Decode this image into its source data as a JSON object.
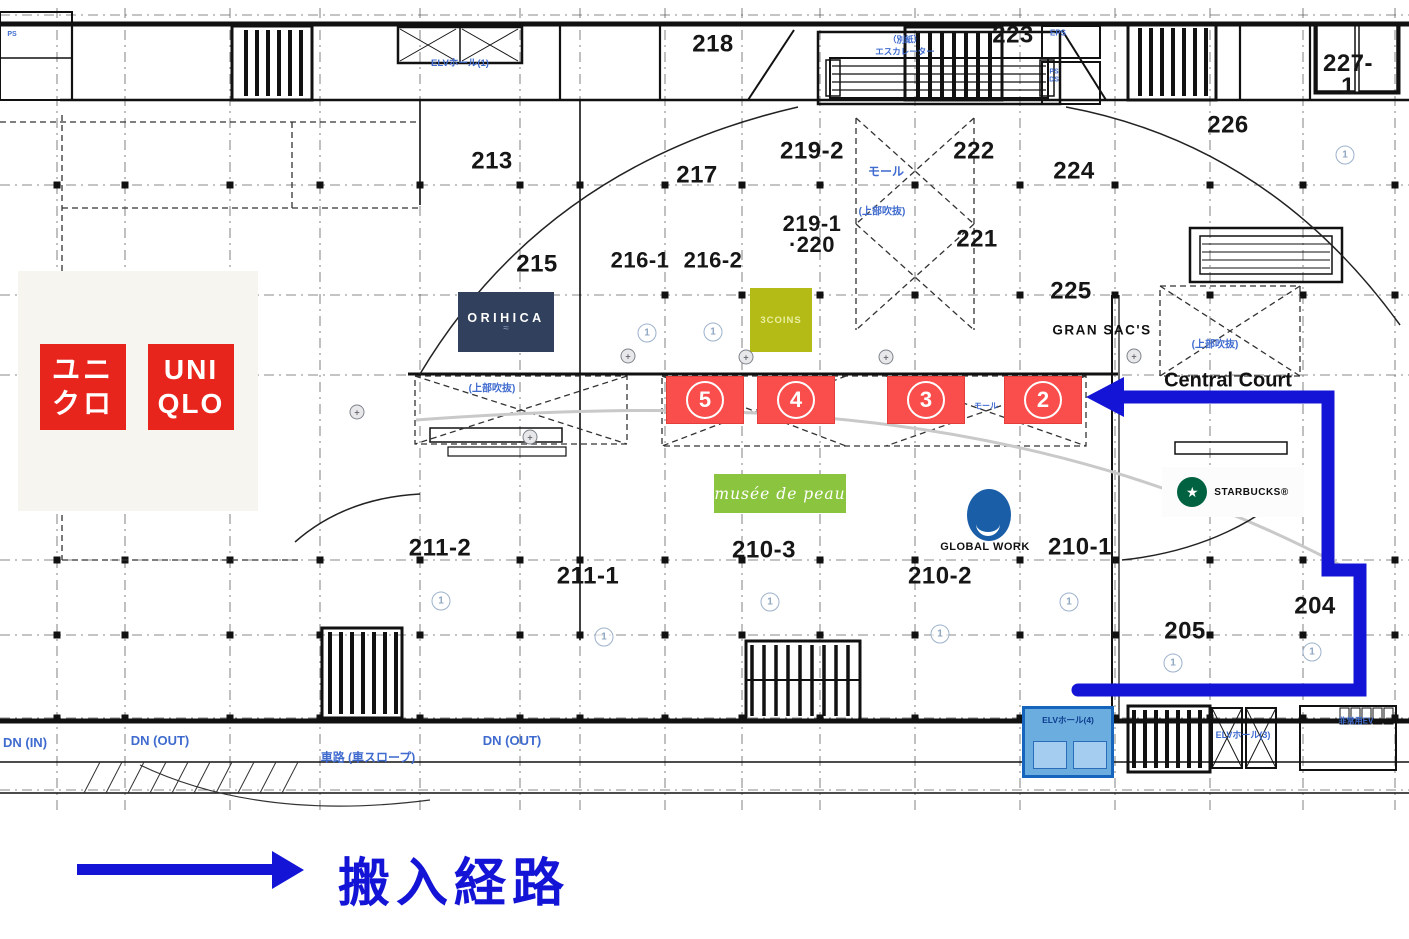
{
  "legend": {
    "route_label": "搬入経路",
    "route_color": "#1414d6"
  },
  "stores": {
    "uniqlo": {
      "kana_top": "ユニ",
      "kana_bottom": "クロ",
      "latin_top": "UNI",
      "latin_bottom": "QLO",
      "brand_color": "#e8251d"
    },
    "orihica": {
      "name": "ORIHICA",
      "tagline_mark": "≈",
      "bg": "#31405d"
    },
    "threecoins": {
      "name": "3COINS",
      "bg": "#b4bb16"
    },
    "musee": {
      "name": "musée de peau",
      "bg": "#8bc53f"
    },
    "globalwork": {
      "name": "GLOBAL WORK",
      "logo_color": "#1b5ea8"
    },
    "starbucks": {
      "name": "STARBUCKS®",
      "logo_color": "#006241",
      "logo_mark": "★"
    },
    "gransacs": {
      "name": "GRAN SAC'S"
    },
    "central_court": {
      "name": "Central Court"
    }
  },
  "route": {
    "color": "#1414d6",
    "badge_color": "#f94e4b",
    "badges": [
      {
        "number": "5",
        "x": 705
      },
      {
        "number": "4",
        "x": 796
      },
      {
        "number": "3",
        "x": 926
      },
      {
        "number": "2",
        "x": 1043
      }
    ],
    "elevator_hall_label": "ELVホール(4)"
  },
  "rooms": [
    {
      "label": "213",
      "x": 492,
      "y": 162
    },
    {
      "label": "215",
      "x": 537,
      "y": 265
    },
    {
      "label": "216-1",
      "x": 640,
      "y": 261,
      "size": 22
    },
    {
      "label": "216-2",
      "x": 713,
      "y": 261,
      "size": 22
    },
    {
      "label": "217",
      "x": 697,
      "y": 176
    },
    {
      "label": "218",
      "x": 713,
      "y": 45
    },
    {
      "label": "219-2",
      "x": 812,
      "y": 152
    },
    {
      "label": "219-1\n·220",
      "x": 812,
      "y": 235,
      "size": 22
    },
    {
      "label": "221",
      "x": 977,
      "y": 240
    },
    {
      "label": "222",
      "x": 974,
      "y": 152
    },
    {
      "label": "223",
      "x": 1013,
      "y": 36
    },
    {
      "label": "224",
      "x": 1074,
      "y": 172
    },
    {
      "label": "225",
      "x": 1071,
      "y": 292
    },
    {
      "label": "226",
      "x": 1228,
      "y": 126
    },
    {
      "label": "227-1",
      "x": 1348,
      "y": 76
    },
    {
      "label": "211-2",
      "x": 440,
      "y": 549
    },
    {
      "label": "211-1",
      "x": 588,
      "y": 577
    },
    {
      "label": "210-3",
      "x": 764,
      "y": 551
    },
    {
      "label": "210-2",
      "x": 940,
      "y": 577
    },
    {
      "label": "210-1",
      "x": 1080,
      "y": 548
    },
    {
      "label": "205",
      "x": 1185,
      "y": 632
    },
    {
      "label": "204",
      "x": 1315,
      "y": 607
    }
  ],
  "plan_labels": [
    {
      "name": "elv-hall-1-label",
      "text": "ELVホール(1)",
      "x": 460,
      "y": 64,
      "size": 9.5
    },
    {
      "name": "eps-label",
      "text": "EPS",
      "x": 1058,
      "y": 34,
      "size": 8
    },
    {
      "name": "ps-ds-label",
      "text": "PS\nDS",
      "x": 1054,
      "y": 76,
      "size": 7
    },
    {
      "name": "ps-left-label",
      "text": "PS",
      "x": 12,
      "y": 35,
      "size": 7
    },
    {
      "name": "bessi-note",
      "text": "（別紙）",
      "x": 905,
      "y": 40,
      "size": 8.5
    },
    {
      "name": "escalator-note",
      "text": "エスカレーター",
      "x": 905,
      "y": 52,
      "size": 8.5
    },
    {
      "name": "mall-label",
      "text": "モール",
      "x": 886,
      "y": 172,
      "size": 12
    },
    {
      "name": "void-note-center",
      "text": "(上部吹抜)",
      "x": 882,
      "y": 212,
      "size": 10
    },
    {
      "name": "void-note-left",
      "text": "(上部吹抜)",
      "x": 492,
      "y": 389,
      "size": 10
    },
    {
      "name": "void-note-right",
      "text": "(上部吹抜)",
      "x": 1215,
      "y": 345,
      "size": 10
    },
    {
      "name": "mall-small-label",
      "text": "モール",
      "x": 986,
      "y": 407,
      "size": 8
    },
    {
      "name": "elv-hall-3-label",
      "text": "ELVホール(3)",
      "x": 1243,
      "y": 736,
      "size": 9
    },
    {
      "name": "emergency-ev-label",
      "text": "非常用EV",
      "x": 1356,
      "y": 722,
      "size": 8
    },
    {
      "name": "dn-in-label",
      "text": "DN (IN)",
      "x": 25,
      "y": 743,
      "size": 13
    },
    {
      "name": "dn-out-label-1",
      "text": "DN (OUT)",
      "x": 160,
      "y": 741,
      "size": 13
    },
    {
      "name": "dn-out-label-2",
      "text": "DN (OUT)",
      "x": 512,
      "y": 741,
      "size": 13
    },
    {
      "name": "ramp-label",
      "text": "車路 (車スロープ)",
      "x": 368,
      "y": 758,
      "size": 12
    }
  ],
  "markers": {
    "circled_glyph": "1",
    "circled": [
      {
        "x": 647,
        "y": 333
      },
      {
        "x": 713,
        "y": 332
      },
      {
        "x": 1345,
        "y": 155
      },
      {
        "x": 441,
        "y": 601
      },
      {
        "x": 604,
        "y": 637
      },
      {
        "x": 770,
        "y": 602
      },
      {
        "x": 940,
        "y": 634
      },
      {
        "x": 1069,
        "y": 602
      },
      {
        "x": 1173,
        "y": 663
      },
      {
        "x": 1312,
        "y": 652
      }
    ],
    "survey_glyph": "+",
    "survey": [
      {
        "x": 628,
        "y": 356
      },
      {
        "x": 746,
        "y": 357
      },
      {
        "x": 886,
        "y": 357
      },
      {
        "x": 1134,
        "y": 356
      },
      {
        "x": 530,
        "y": 437
      },
      {
        "x": 357,
        "y": 412
      }
    ]
  }
}
